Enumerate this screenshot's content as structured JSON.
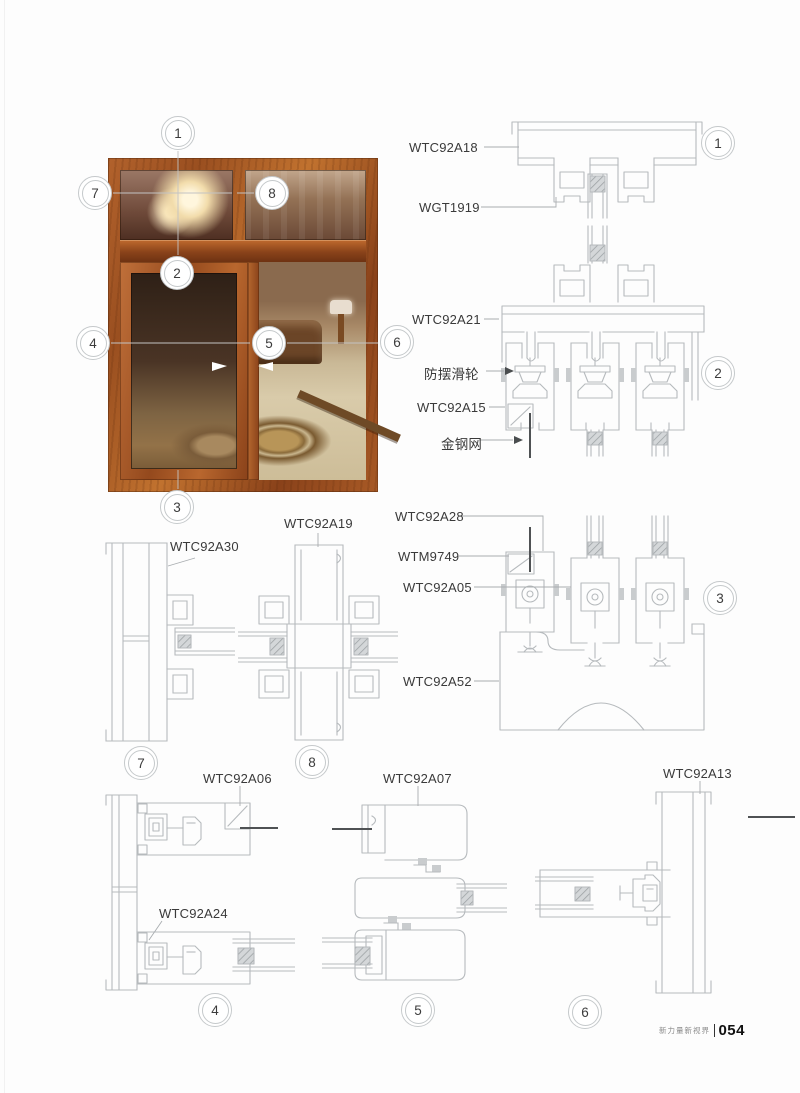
{
  "footer": {
    "brand": "新力量新视界",
    "page_number": "054"
  },
  "callouts": {
    "n1": "1",
    "n2": "2",
    "n3": "3",
    "n4": "4",
    "n5": "5",
    "n6": "6",
    "n7": "7",
    "n8": "8"
  },
  "labels": {
    "wtc92a18": "WTC92A18",
    "wgt1919": "WGT1919",
    "wtc92a21": "WTC92A21",
    "anti_sway_roller": "防摆滑轮",
    "wtc92a15": "WTC92A15",
    "steel_mesh": "金钢网",
    "wtc92a28": "WTC92A28",
    "wtm9749": "WTM9749",
    "wtc92a05": "WTC92A05",
    "wtc92a52": "WTC92A52",
    "wtc92a30": "WTC92A30",
    "wtc92a19": "WTC92A19",
    "wtc92a06": "WTC92A06",
    "wtc92a24": "WTC92A24",
    "wtc92a07": "WTC92A07",
    "wtc92a13": "WTC92A13"
  },
  "colors": {
    "drawing_line": "#b6babd",
    "label_text": "#3a3a3a",
    "screen_mesh_line": "#4f5254",
    "wood_frame": "#a0521f"
  }
}
